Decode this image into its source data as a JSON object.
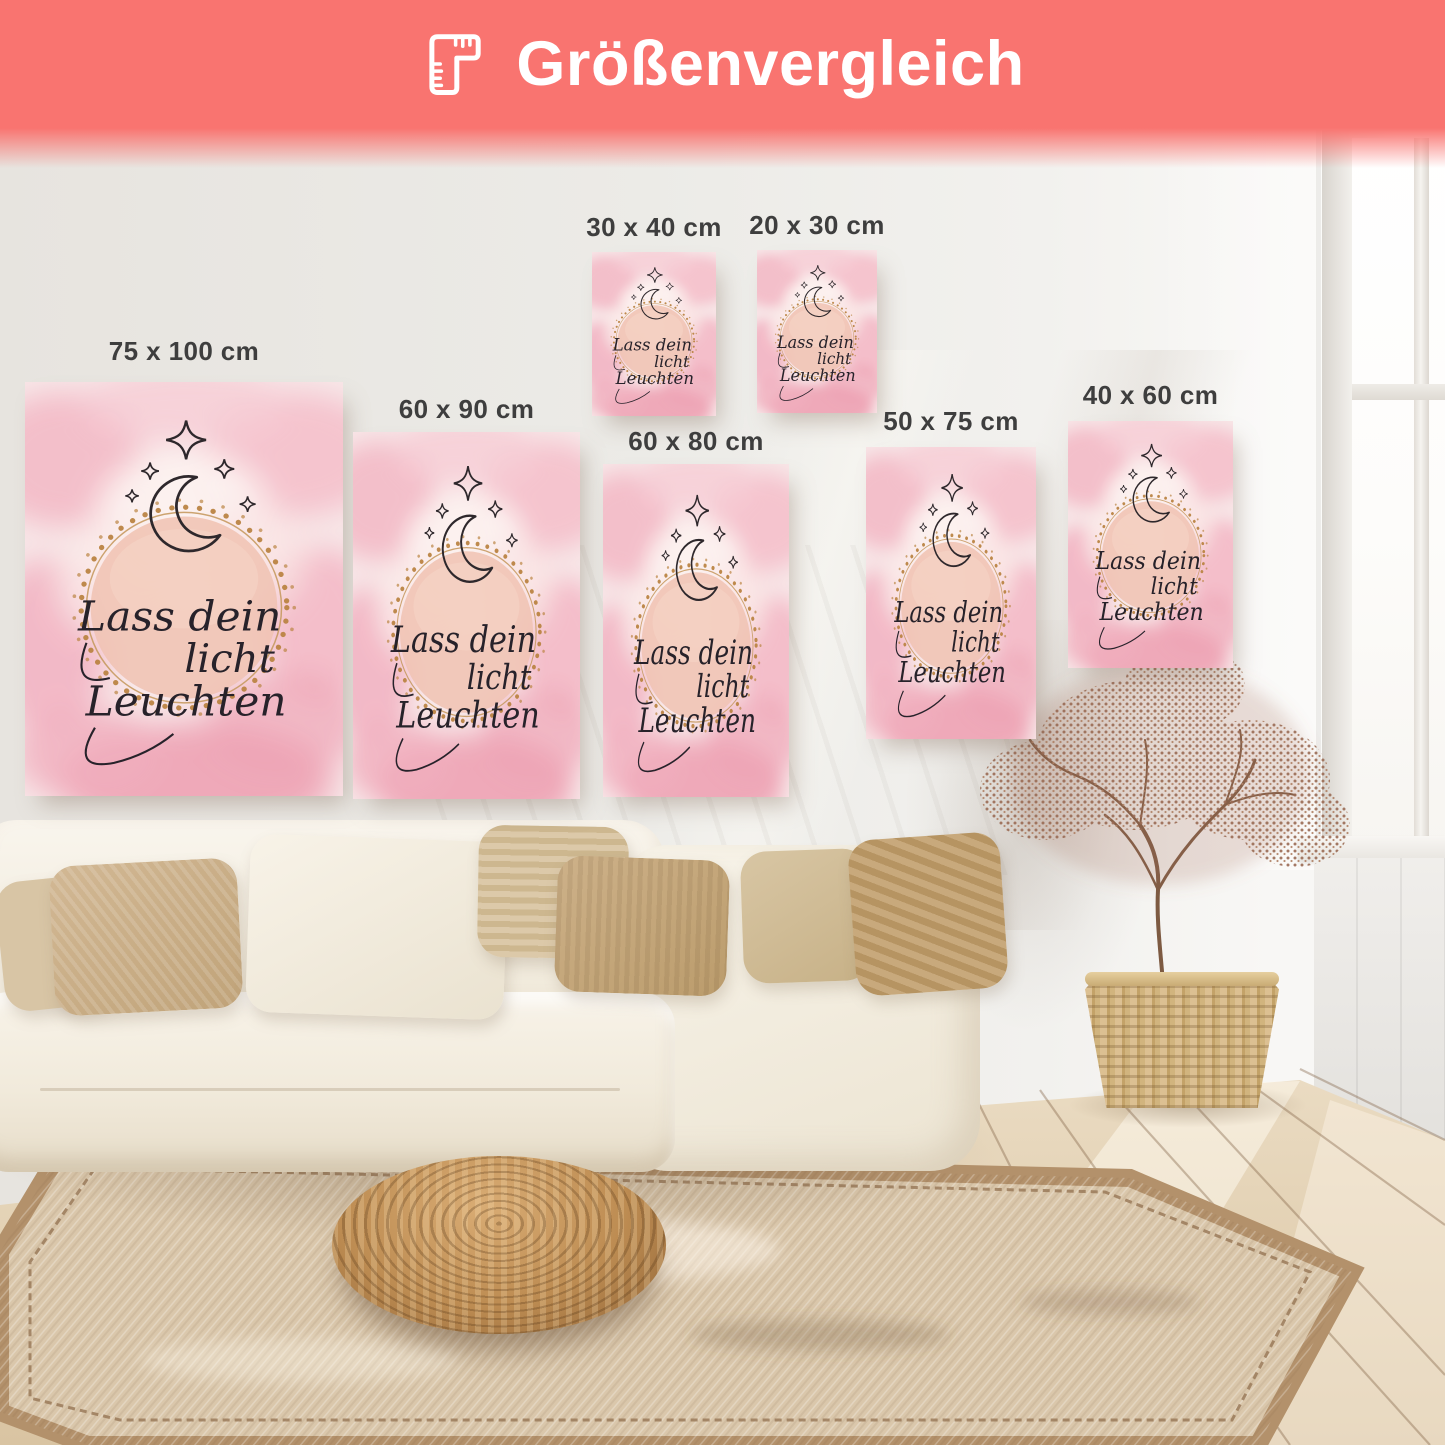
{
  "header": {
    "title": "Größenvergleich",
    "icon": "folding-ruler-icon"
  },
  "posters": [
    {
      "id": "75x100",
      "size_label": "75 x 100 cm",
      "width_cm": 75,
      "height_cm": 100
    },
    {
      "id": "60x90",
      "size_label": "60 x 90 cm",
      "width_cm": 60,
      "height_cm": 90
    },
    {
      "id": "30x40",
      "size_label": "30 x 40 cm",
      "width_cm": 30,
      "height_cm": 40
    },
    {
      "id": "20x30",
      "size_label": "20 x 30 cm",
      "width_cm": 20,
      "height_cm": 30
    },
    {
      "id": "60x80",
      "size_label": "60 x 80 cm",
      "width_cm": 60,
      "height_cm": 80
    },
    {
      "id": "50x75",
      "size_label": "50 x 75 cm",
      "width_cm": 50,
      "height_cm": 75
    },
    {
      "id": "40x60",
      "size_label": "40 x 60 cm",
      "width_cm": 40,
      "height_cm": 60
    }
  ],
  "poster_design": {
    "line1": "Lass dein",
    "line2": "licht",
    "line3": "Leuchten"
  },
  "palette": {
    "header_coral": "#f97470",
    "header_text": "#ffffff",
    "label_text": "#3e3e3e",
    "poster_pink": "#f5c9d1",
    "accent_gold": "#bb8443",
    "script_ink": "#2a2428",
    "wall": "#edebe7",
    "sofa_cream": "#f5f0e5",
    "wood_floor": "#e3d2b6"
  }
}
